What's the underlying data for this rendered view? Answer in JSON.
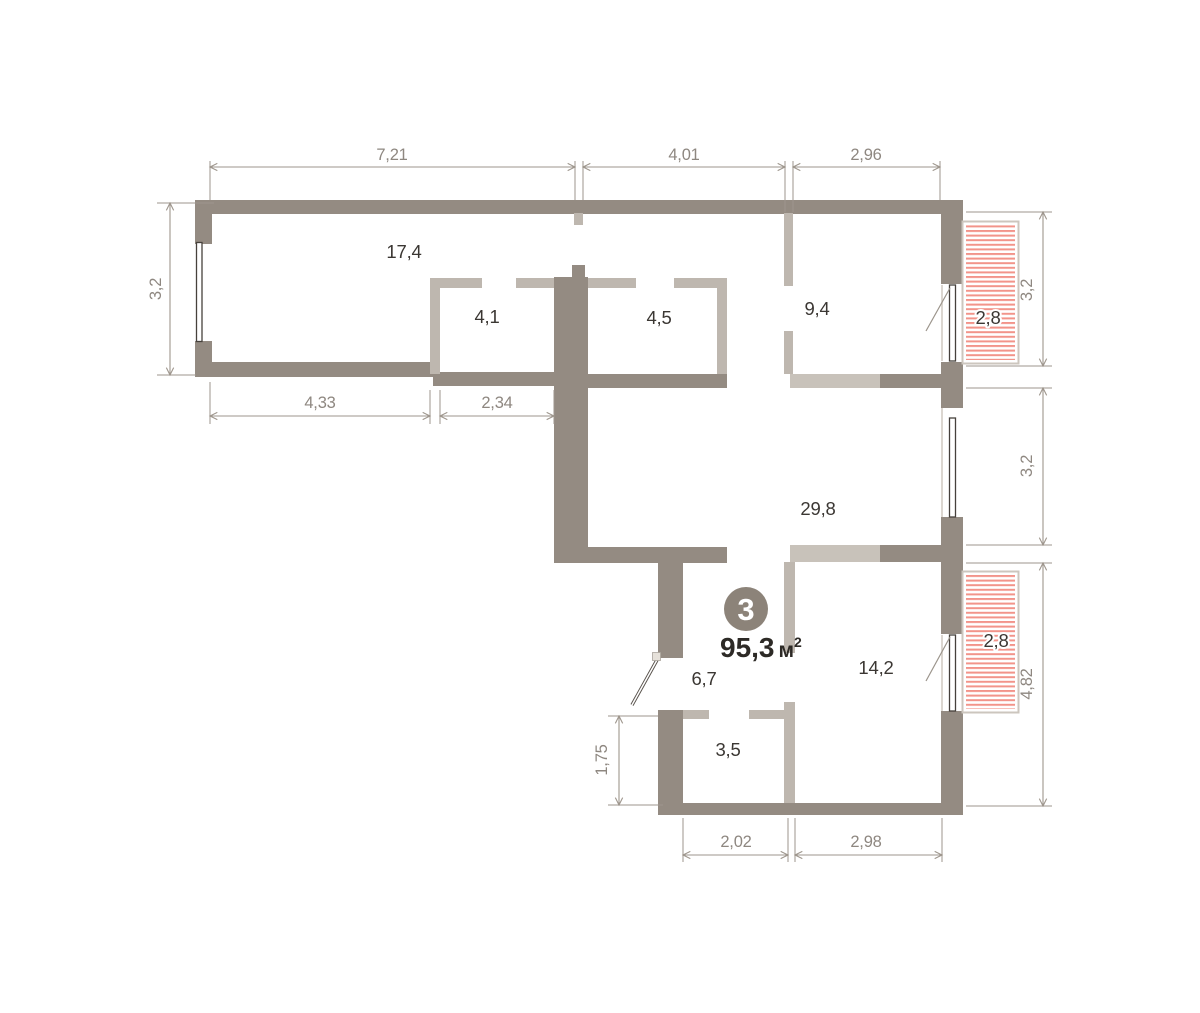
{
  "colors": {
    "bg": "#ffffff",
    "wall_dark": "#948b82",
    "wall_light": "#beb7af",
    "wall_lighter": "#c8c2ba",
    "window_line": "#46413c",
    "dim": "#9e968d",
    "dim_text": "#8e8780",
    "room_text": "#3b3733",
    "hatch": "#f2948a",
    "balcony_border": "#ccc6be",
    "badge": "#8c8379",
    "badge_text": "#ffffff",
    "total_text": "#2d2a26"
  },
  "badge": {
    "number": "3"
  },
  "total": {
    "value": "95,3",
    "unit": "м",
    "sup": "2"
  },
  "rooms": {
    "r17_4": "17,4",
    "r4_1": "4,1",
    "r4_5": "4,5",
    "r9_4": "9,4",
    "r2_8_top": "2,8",
    "r29_8": "29,8",
    "r6_7": "6,7",
    "r14_2": "14,2",
    "r3_5": "3,5",
    "r2_8_bottom": "2,8"
  },
  "dims": {
    "top_1": "7,21",
    "top_2": "4,01",
    "top_3": "2,96",
    "left": "3,2",
    "bottom_left_1": "4,33",
    "bottom_left_2": "2,34",
    "right_1": "3,2",
    "right_2": "3,2",
    "right_3": "4,82",
    "inner_left": "1,75",
    "bottom_1": "2,02",
    "bottom_2": "2,98"
  }
}
